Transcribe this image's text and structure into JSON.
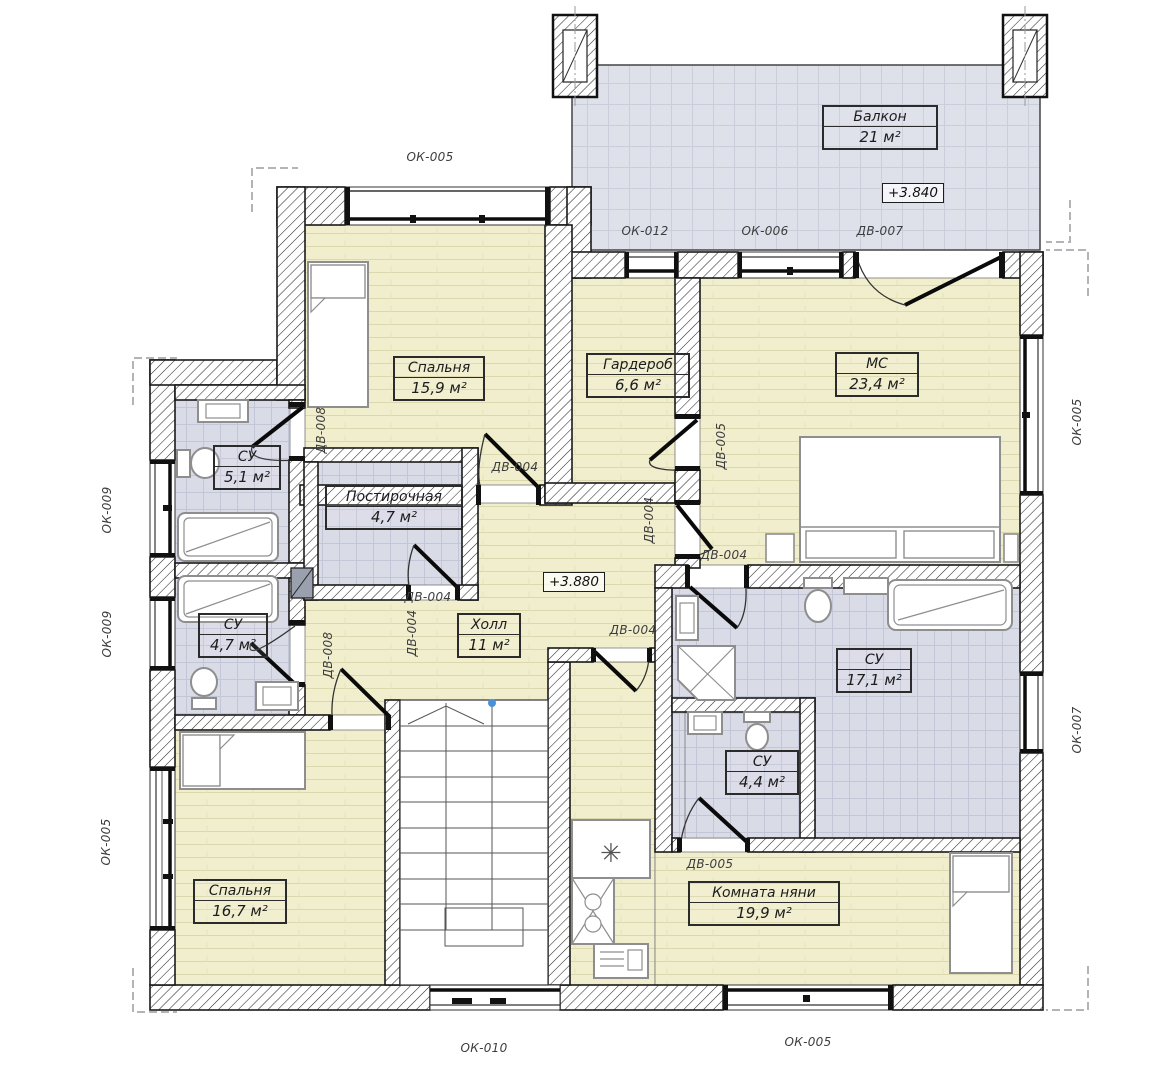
{
  "codes": {
    "ok005": "ОК-005",
    "ok006": "ОК-006",
    "ok007": "ОК-007",
    "ok009": "ОК-009",
    "ok010": "ОК-010",
    "ok012": "ОК-012",
    "dv004": "ДВ-004",
    "dv005": "ДВ-005",
    "dv007": "ДВ-007",
    "dv008": "ДВ-008"
  },
  "rooms": {
    "balcony": {
      "name": "Балкон",
      "area": "21 м²"
    },
    "bedroom1": {
      "name": "Спальня",
      "area": "15,9 м²"
    },
    "wardrobe": {
      "name": "Гардероб",
      "area": "6,6 м²"
    },
    "master": {
      "name": "МС",
      "area": "23,4 м²"
    },
    "bath51": {
      "name": "СУ",
      "area": "5,1 м²"
    },
    "laundry": {
      "name": "Постирочная",
      "area": "4,7 м²"
    },
    "bath47": {
      "name": "СУ",
      "area": "4,7 м²"
    },
    "hall": {
      "name": "Холл",
      "area": "11 м²"
    },
    "bath171": {
      "name": "СУ",
      "area": "17,1 м²"
    },
    "bath44": {
      "name": "СУ",
      "area": "4,4 м²"
    },
    "bedroom2": {
      "name": "Спальня",
      "area": "16,7 м²"
    },
    "nanny": {
      "name": "Комната няни",
      "area": "19,9 м²"
    }
  },
  "levels": {
    "balcony": "+3.840",
    "floor": "+3.880"
  },
  "colors": {
    "floor_wood": "#f0eecd",
    "floor_tile": "#d9dbe6",
    "balcony": "#dee0ea",
    "wall_line": "#1a1a1a"
  }
}
